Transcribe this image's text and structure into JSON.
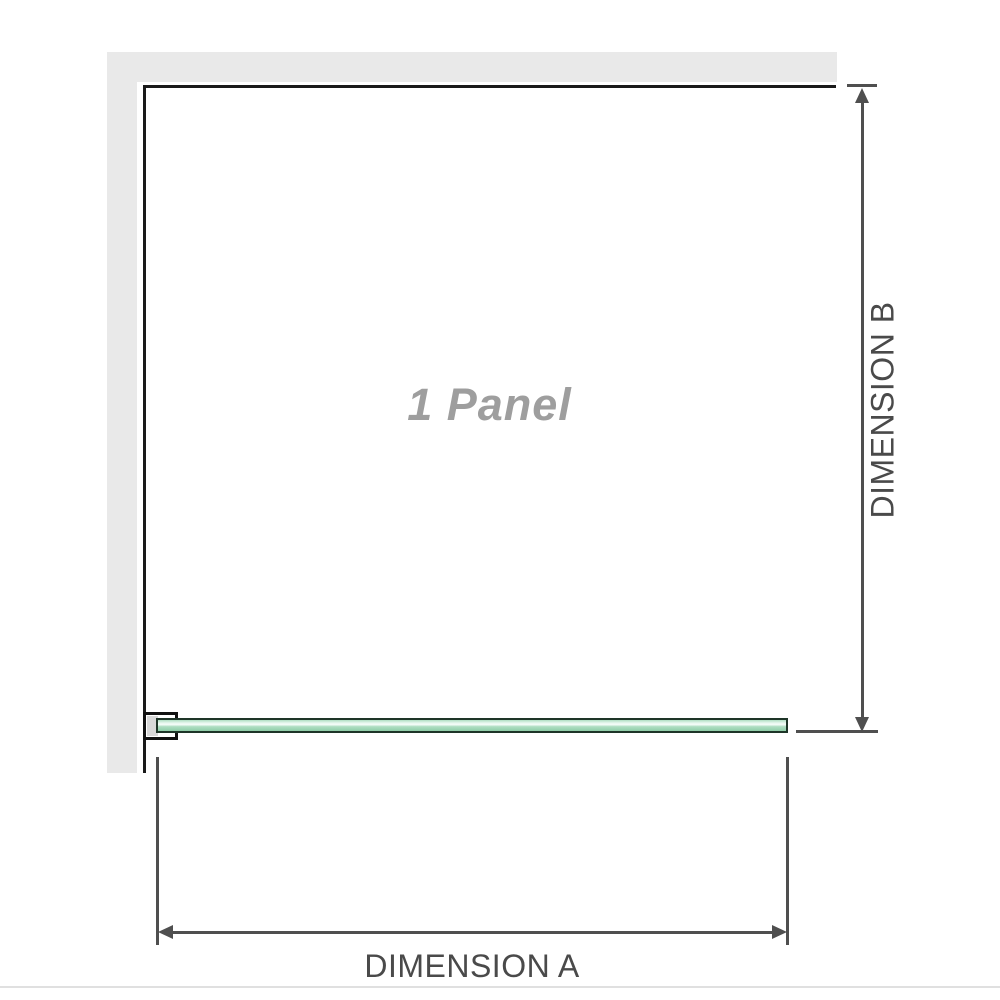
{
  "diagram": {
    "panel_label": "1 Panel",
    "dimension_a": {
      "label": "DIMENSION A",
      "measures": "panel width"
    },
    "dimension_b": {
      "label": "DIMENSION B",
      "measures": "panel height"
    }
  },
  "colors": {
    "background": "#ffffff",
    "wall": "#e9e9e9",
    "panel_outline": "#1a1a1a",
    "dimension": "#4f4f4f",
    "label_text": "#4a4a4a",
    "watermark_text": "#9e9e9e",
    "glass_border": "#1e3528",
    "glass_green_light": "#eaf8f0",
    "glass_green": "#aedec2",
    "glass_green_dark": "#8fcda8",
    "bracket_fill": "#d8d8d8",
    "baseline_divider": "#e0e0e0"
  }
}
